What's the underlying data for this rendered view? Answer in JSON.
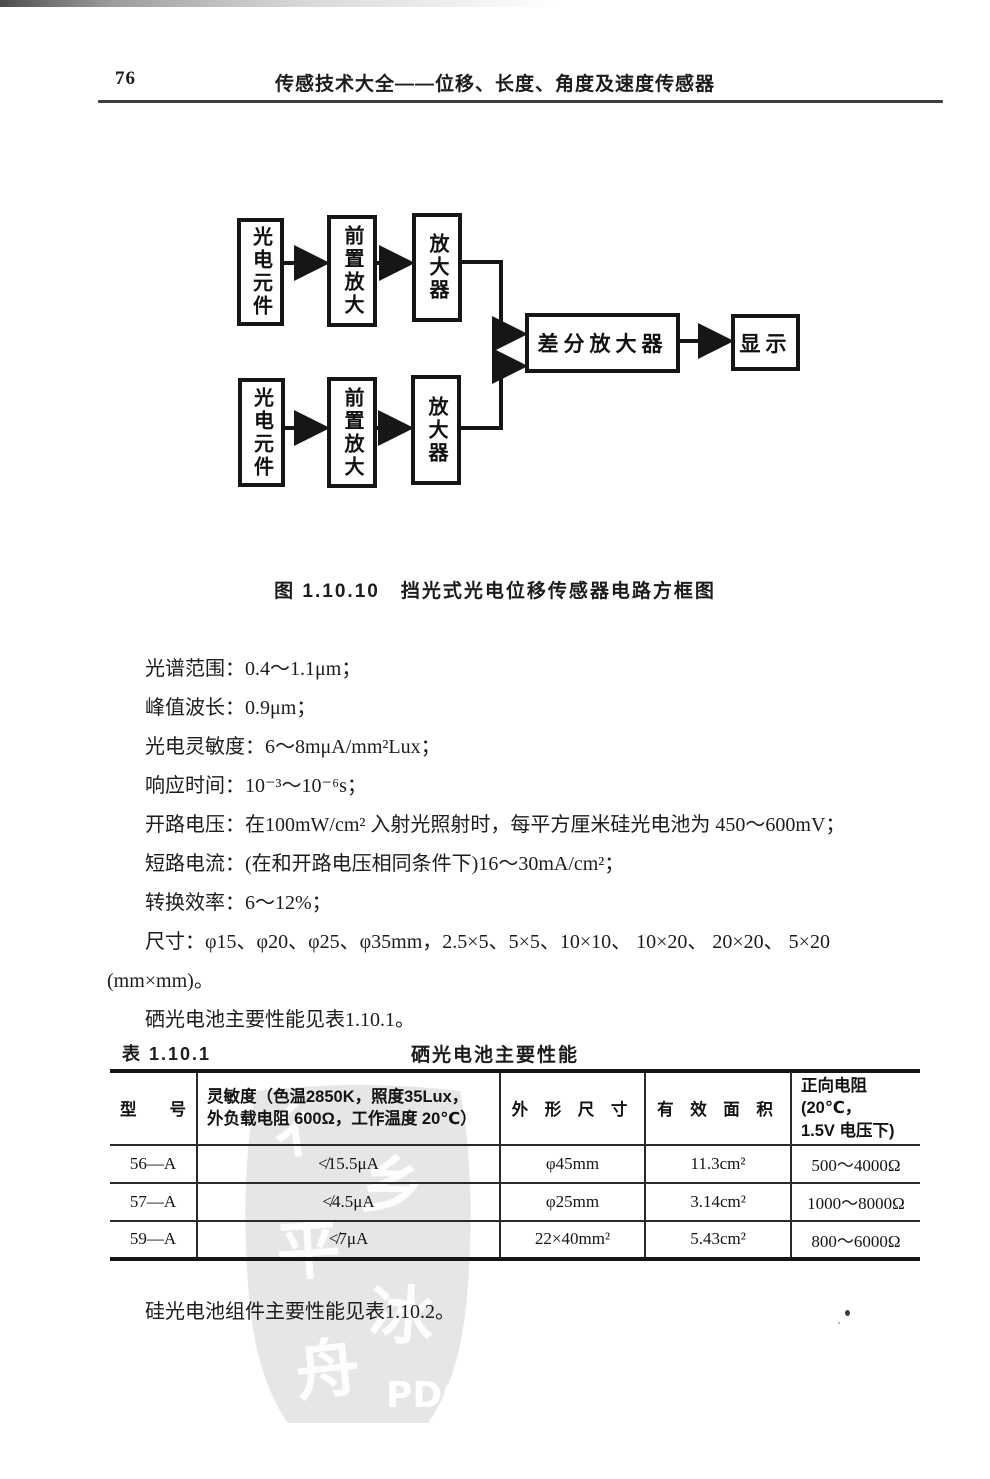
{
  "page": {
    "number": "76",
    "header_title": "传感技术大全——位移、长度、角度及速度传感器",
    "footer_note": "硅光电池组件主要性能见表1.10.2。"
  },
  "diagram": {
    "caption": "图 1.10.10　挡光式光电位移传感器电路方框图",
    "boxes": {
      "photocell_top": "光电元件",
      "preamp_top": "前置放大",
      "amp_top": "放大器",
      "photocell_bottom": "光电元件",
      "preamp_bottom": "前置放大",
      "amp_bottom": "放大器",
      "diff_amp": "差分放大器",
      "display": "显示"
    }
  },
  "specs": {
    "lines": [
      "光谱范围：0.4～1.1μm；",
      "峰值波长：0.9μm；",
      "光电灵敏度：6～8mμA/mm²Lux；",
      "响应时间：10⁻³～10⁻⁶s；",
      "开路电压：在100mW/cm² 入射光照射时，每平方厘米硅光电池为 450～600mV；",
      "短路电流：(在和开路电压相同条件下)16～30mA/cm²；",
      "转换效率：6～12%；",
      "尺寸：φ15、φ20、φ25、φ35mm，2.5×5、5×5、10×10、  10×20、  20×20、  5×20",
      "(mm×mm)。",
      "硒光电池主要性能见表1.10.1。"
    ]
  },
  "table": {
    "label": "表 1.10.1",
    "title": "硒光电池主要性能",
    "headers": [
      "型　　号",
      "灵敏度（色温2850K，照度35Lux，\n外负载电阻 600Ω，工作温度 20℃）",
      "外 形 尺 寸",
      "有 效 面 积",
      "正向电阻(20℃，\n1.5V 电压下)"
    ],
    "rows": [
      [
        "56—A",
        "≮15.5μA",
        "φ45mm",
        "11.3cm²",
        "500～4000Ω"
      ],
      [
        "57—A",
        "≮4.5μA",
        "φ25mm",
        "3.14cm²",
        "1000～8000Ω"
      ],
      [
        "59—A",
        "≮7μA",
        "22×40mm²",
        "5.43cm²",
        "800～6000Ω"
      ]
    ]
  },
  "watermark": {
    "text": "PDG"
  },
  "colors": {
    "ink": "#1c1c1c",
    "rule": "#3f3f3f",
    "watermark_gray": "#e4e4e4"
  }
}
